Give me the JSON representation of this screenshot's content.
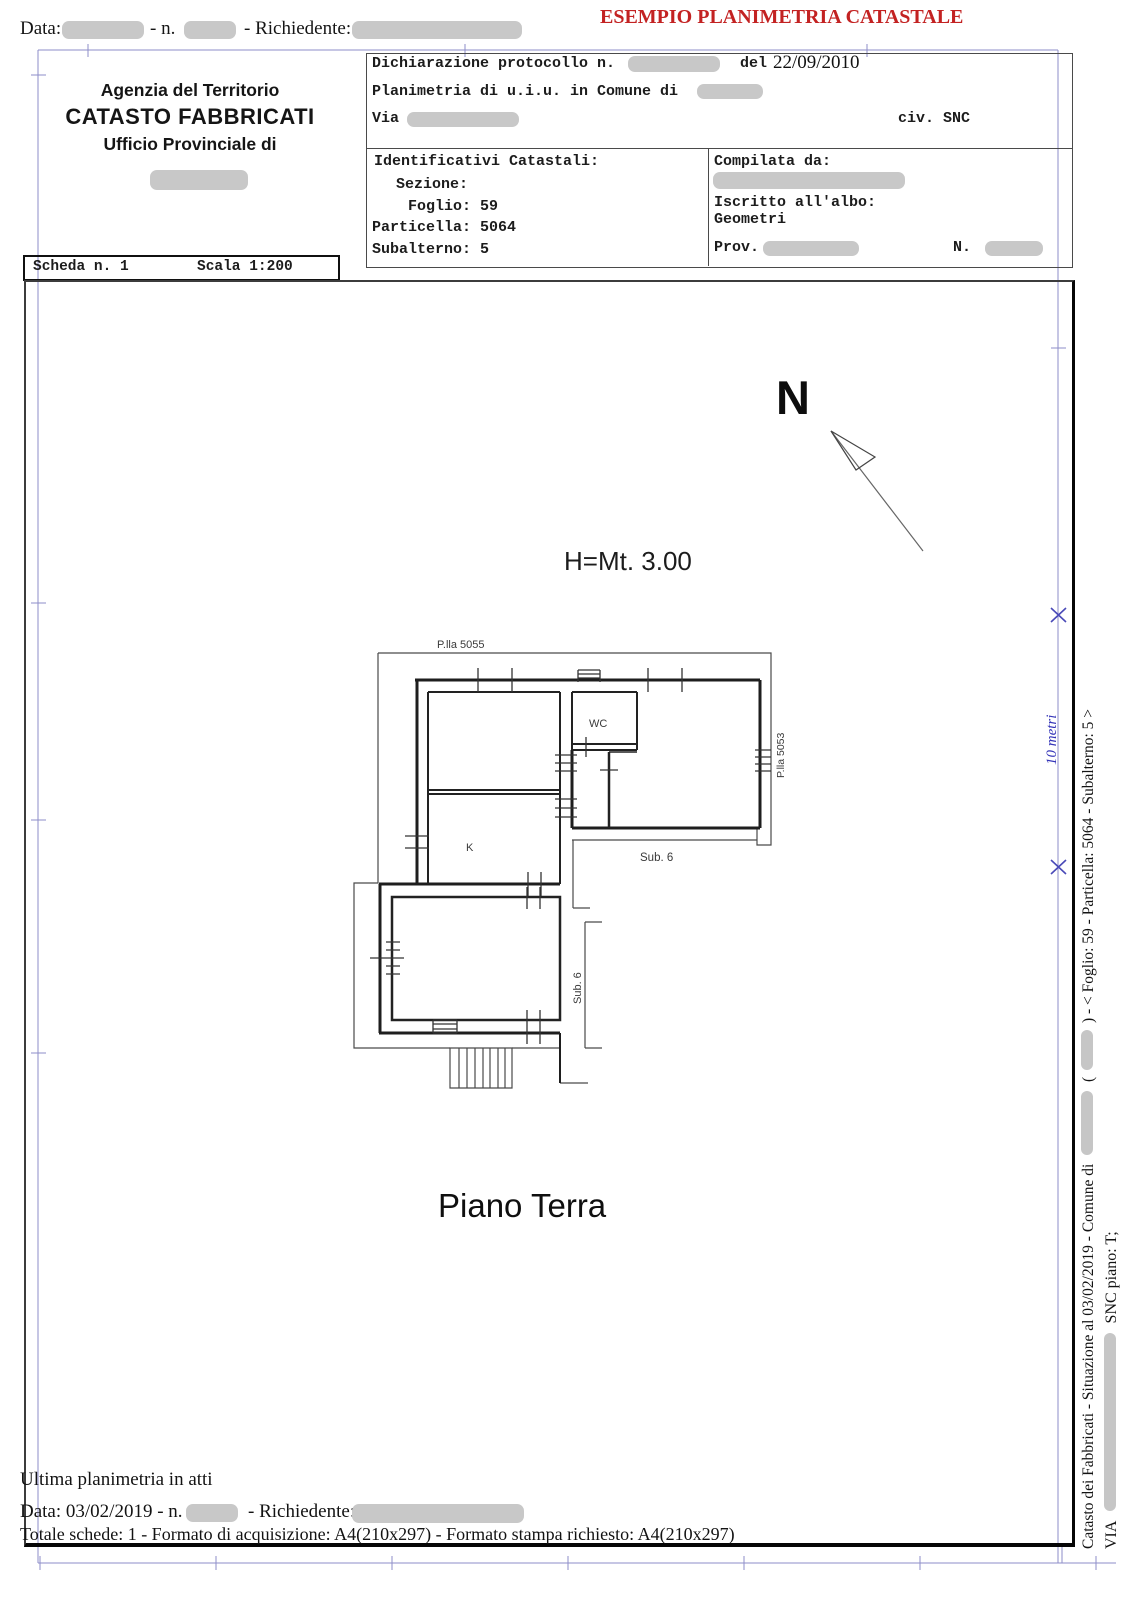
{
  "topbar": {
    "data_label": "Data:",
    "n_label": "- n.",
    "richiedente_label": "- Richiedente:",
    "red_title": "ESEMPIO PLANIMETRIA CATASTALE"
  },
  "header_left": {
    "line1": "Agenzia del Territorio",
    "line2": "CATASTO FABBRICATI",
    "line3": "Ufficio Provinciale di"
  },
  "header_right": {
    "dichiarazione_label": "Dichiarazione protocollo n.",
    "del_label": "del",
    "date": "22/09/2010",
    "planimetria_label": "Planimetria di u.i.u. in Comune di",
    "via_label": "Via",
    "civ": "civ. SNC",
    "identificativi_title": "Identificativi Catastali:",
    "sezione": "Sezione:",
    "foglio": "Foglio: 59",
    "particella": "Particella: 5064",
    "subalterno": "Subalterno: 5",
    "compilata": "Compilata da:",
    "iscritto": "Iscritto all'albo:",
    "albo": "Geometri",
    "prov_label": "Prov.",
    "n_label": "N."
  },
  "scheda": {
    "scheda": "Scheda n. 1",
    "scala": "Scala 1:200"
  },
  "plan": {
    "north": "N",
    "height_label": "H=Mt. 3.00",
    "plla_top": "P.lla 5055",
    "plla_right": "P.lla 5053",
    "wc": "WC",
    "k": "K",
    "sub6_h": "Sub. 6",
    "sub6_v": "Sub. 6",
    "floor_label": "Piano Terra",
    "blue_note": "10 metri"
  },
  "side_text": {
    "line1_part1": "Catasto dei Fabbricati - Situazione al 03/02/2019 - Comune di",
    "line1_part2": "(",
    "line1_part3": ") - < Foglio: 59 - Particella: 5064 - Subalterno: 5 >",
    "line2_part1": "VIA",
    "line2_part2": "SNC piano: T;"
  },
  "footer": {
    "ultima": "Ultima planimetria in atti",
    "data_part1": "Data: 03/02/2019 - n.",
    "data_part2": "- Richiedente:",
    "totale": "Totale schede: 1 - Formato di acquisizione: A4(210x297)  - Formato stampa richiesto: A4(210x297)"
  },
  "colors": {
    "red_title": "#c32222",
    "blue_marks": "#8d8dc9",
    "blue_ink": "#3434b8",
    "redaction": "#c8c8c8"
  }
}
